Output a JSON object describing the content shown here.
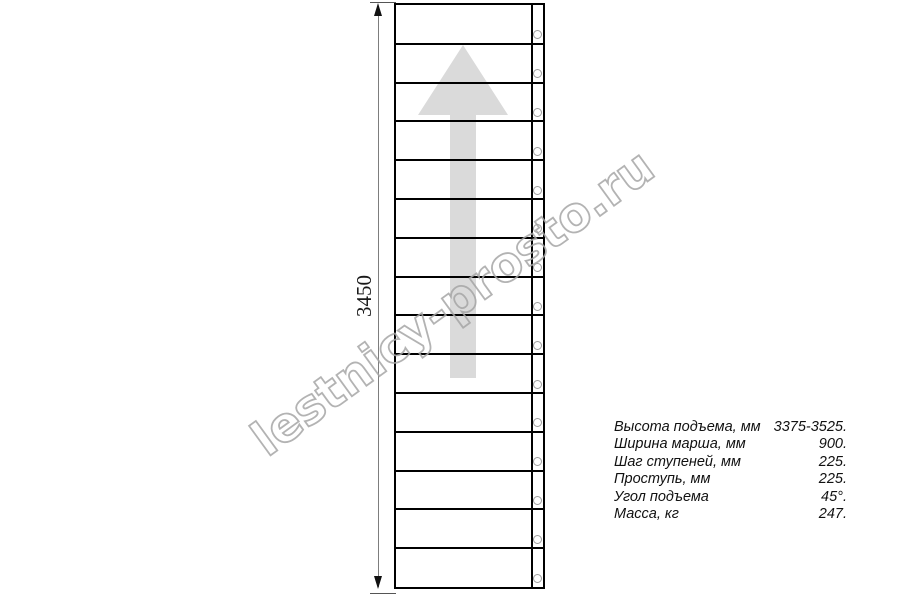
{
  "drawing": {
    "dimension_label": "3450",
    "steps_count": 15,
    "watermark_text": "lestnicy-prosto.ru",
    "colors": {
      "outline": "#000000",
      "direction_arrow": "#dadada",
      "watermark": "#a6a6a6",
      "screw_circle": "#9e9e9e",
      "dimension_line": "#7d7d7d",
      "text": "#111111"
    }
  },
  "specs": {
    "rows": [
      {
        "label": "Высота подъема, мм",
        "value": "3375-3525."
      },
      {
        "label": "Ширина марша, мм",
        "value": "900."
      },
      {
        "label": "Шаг ступеней, мм",
        "value": "225."
      },
      {
        "label": "Проступь, мм",
        "value": "225."
      },
      {
        "label": "Угол подъема",
        "value": "45°."
      },
      {
        "label": "Масса, кг",
        "value": "247."
      }
    ]
  }
}
